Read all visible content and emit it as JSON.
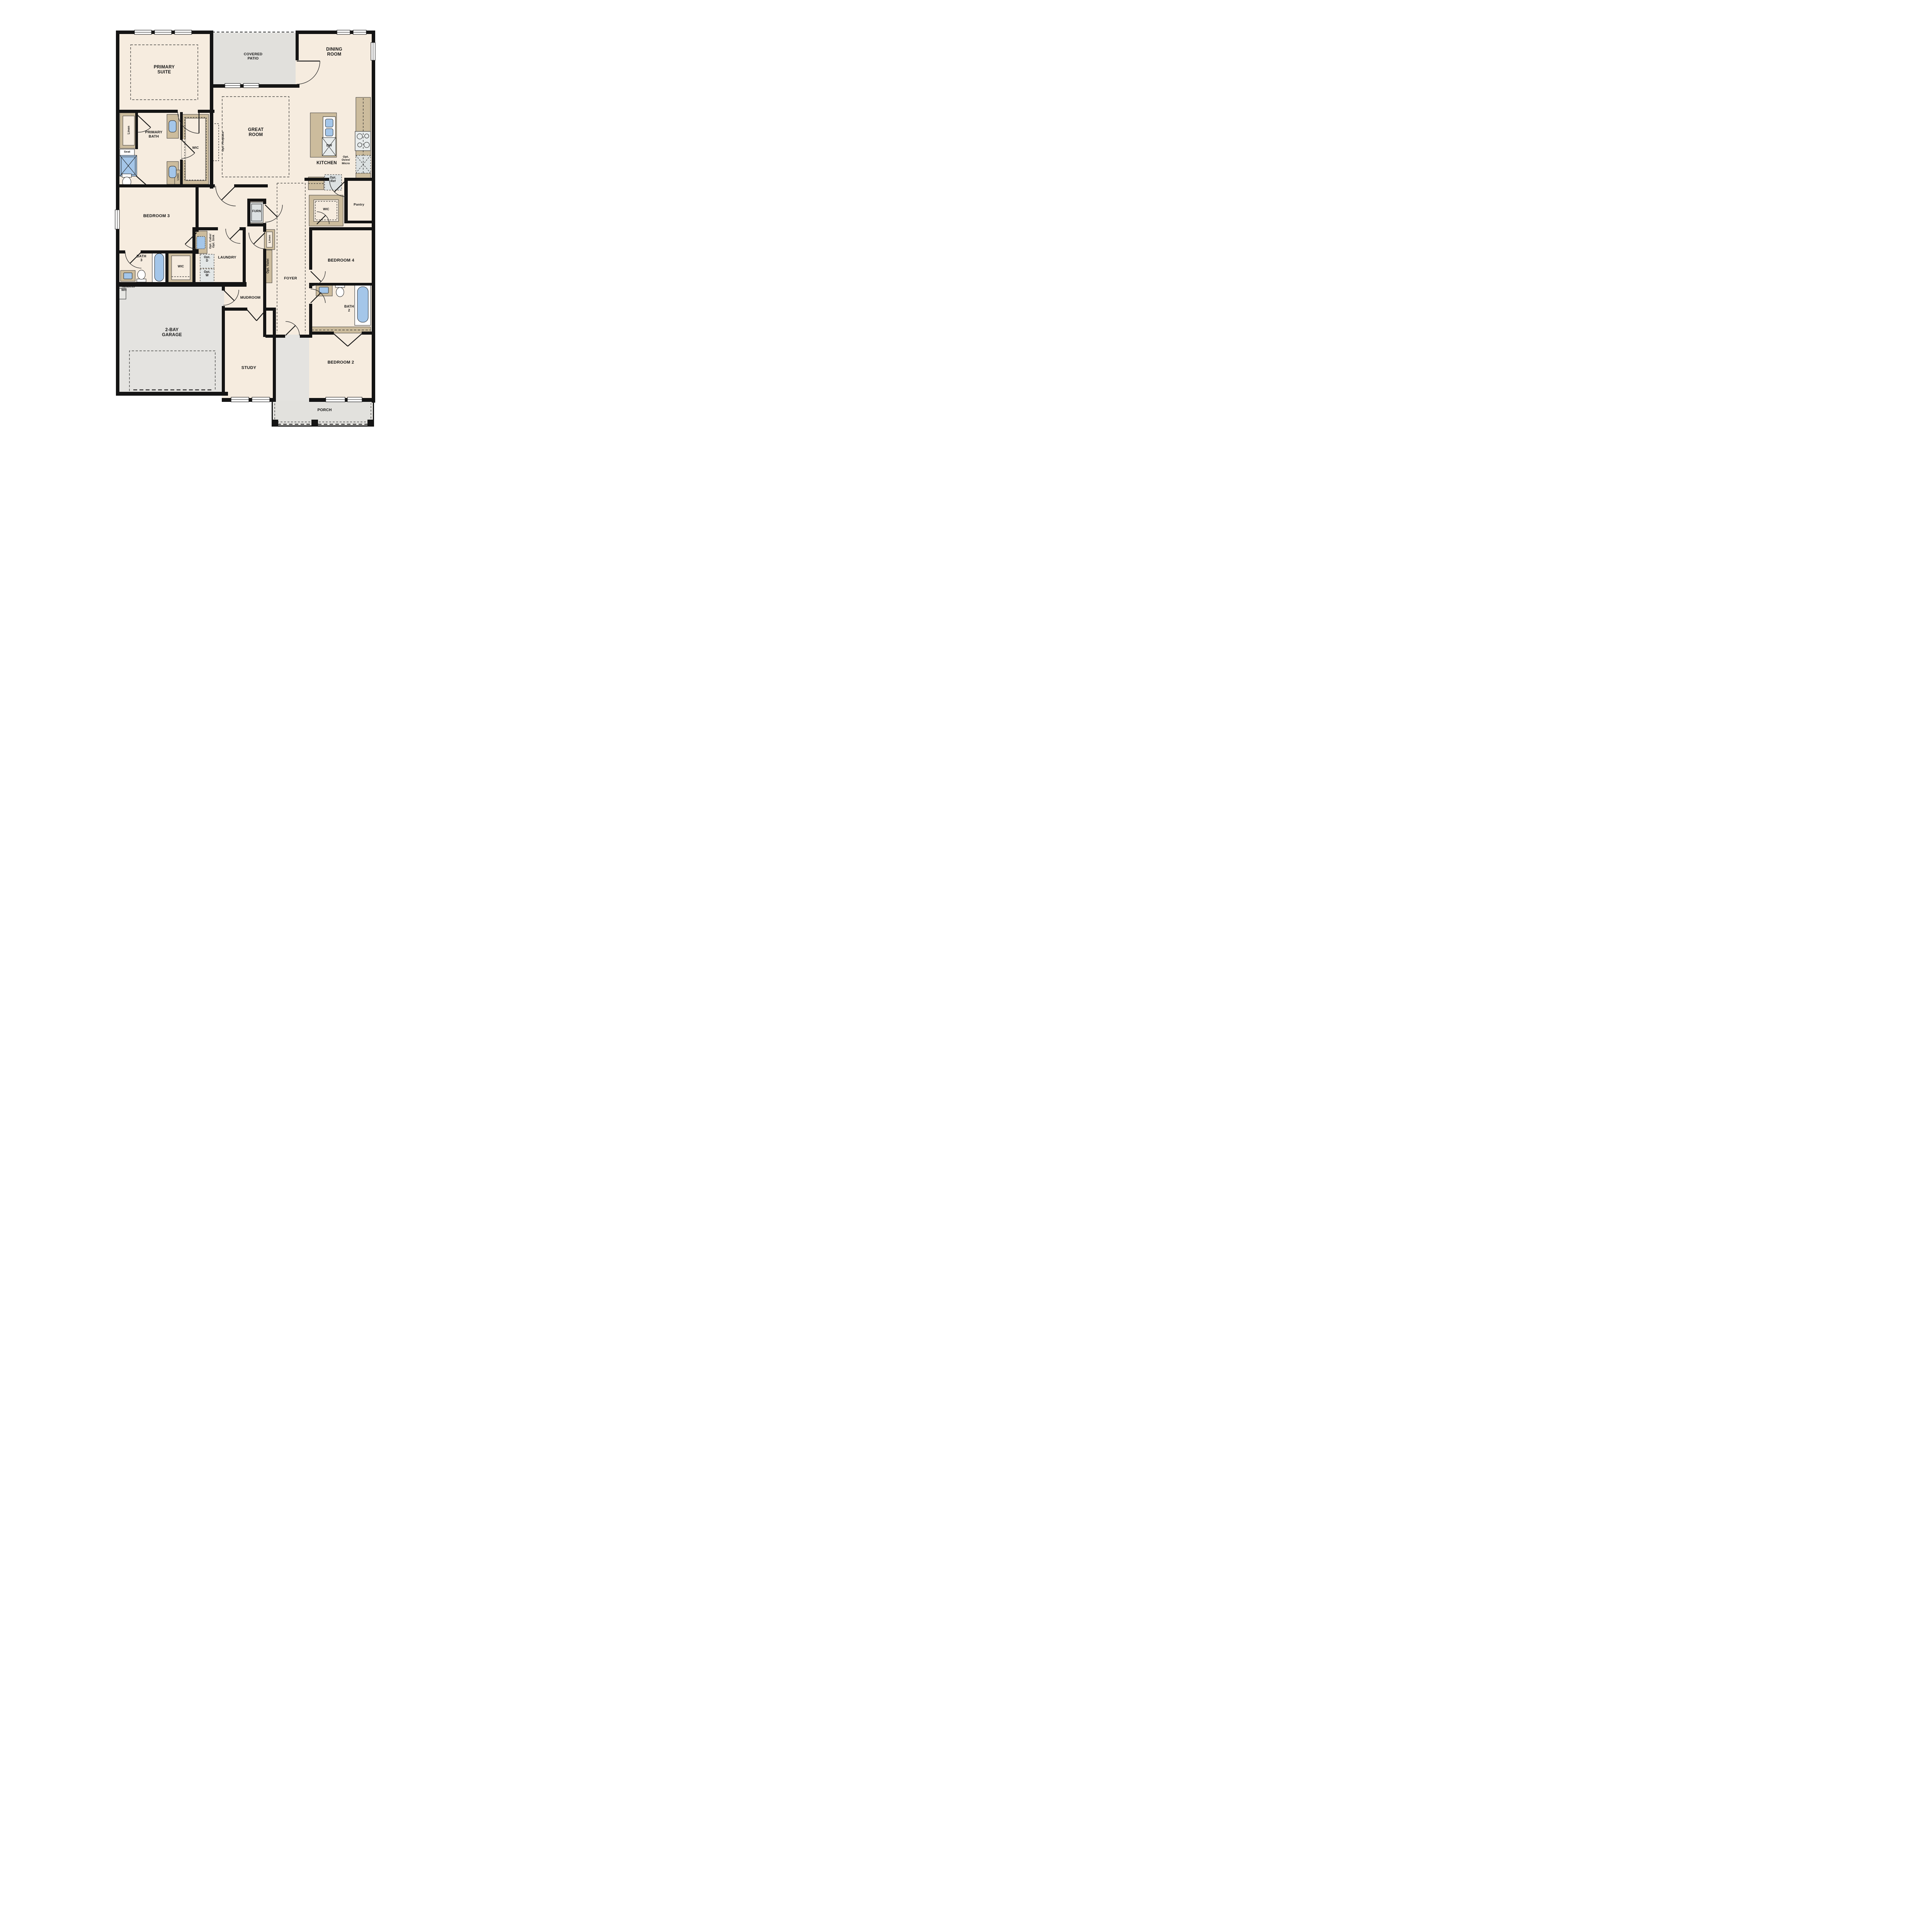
{
  "title": "Single-story floor plan",
  "colors": {
    "wall": "#141414",
    "floor_cream": "#f6ecdf",
    "outdoor_gray": "#e2e1dd",
    "casework_tan": "#ccbc9d",
    "fixture_blue": "#a4c6e9",
    "appliance_gray": "#dce1e2"
  },
  "rooms": {
    "primary_suite": {
      "label": "PRIMARY\nSUITE"
    },
    "covered_patio": {
      "label": "COVERED\nPATIO"
    },
    "dining_room": {
      "label": "DINING\nROOM"
    },
    "great_room": {
      "label": "GREAT\nROOM"
    },
    "kitchen": {
      "label": "KITCHEN"
    },
    "primary_bath": {
      "label": "PRIMARY\nBATH"
    },
    "wic_primary": {
      "label": "WIC"
    },
    "bedroom_3": {
      "label": "BEDROOM 3"
    },
    "bath_3": {
      "label": "BATH\n3"
    },
    "wic_bath3": {
      "label": "WIC"
    },
    "laundry": {
      "label": "LAUNDRY"
    },
    "mudroom": {
      "label": "MUDROOM"
    },
    "foyer": {
      "label": "FOYER"
    },
    "bedroom_4": {
      "label": "BEDROOM 4"
    },
    "wic_kitchen": {
      "label": "WIC"
    },
    "pantry": {
      "label": "Pantry"
    },
    "bath_2": {
      "label": "BATH\n2"
    },
    "bedroom_2": {
      "label": "BEDROOM 2"
    },
    "study": {
      "label": "STUDY"
    },
    "garage": {
      "label": "2-BAY\nGARAGE"
    },
    "porch": {
      "label": "PORCH"
    }
  },
  "annotations": {
    "opt_fireplace": "Opt. Fireplace",
    "opt_oven_micro": "Opt.\nOven/\nMicro",
    "opt_ref": "Opt.\nRef",
    "dw": "DW",
    "furn": "FURN",
    "opt_valet": "Opt. Valet",
    "opt_cabs_sink": "Opt. Cabs/\nOpt. Sink",
    "opt_d": "Opt.\nD",
    "opt_w": "Opt.\nW",
    "linen_primary": "Linen",
    "linen_wic": "Linen",
    "linen_foyer": "Linen",
    "seat": "Seat",
    "tankless_wh": "Tankless\nWH"
  }
}
